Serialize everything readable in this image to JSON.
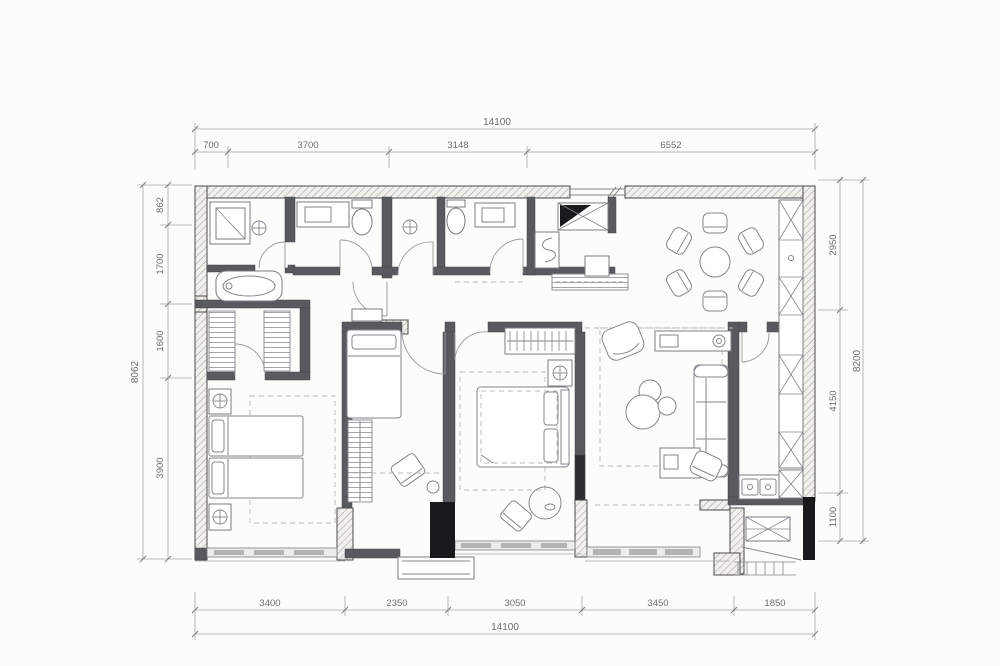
{
  "drawing": {
    "type": "architectural-floor-plan",
    "colors": {
      "paper": "#fcfcfb",
      "wall_hatch": "#f1f0ed",
      "interior_wall": "#595a5e",
      "structural_column": "#1a1a1c",
      "dimension_text": "#6d6d6b"
    },
    "dimensions": {
      "top": {
        "total": "14100",
        "segments": [
          "700",
          "3700",
          "3148",
          "6552"
        ]
      },
      "bottom": {
        "total": "14100",
        "segments": [
          "3400",
          "2350",
          "3050",
          "3450",
          "1850"
        ]
      },
      "left": {
        "total": "8062",
        "segments": [
          "862",
          "1700",
          "1600",
          "3900"
        ]
      },
      "right": {
        "total": "8200",
        "segments": [
          "2950",
          "4150",
          "1100"
        ]
      }
    }
  }
}
